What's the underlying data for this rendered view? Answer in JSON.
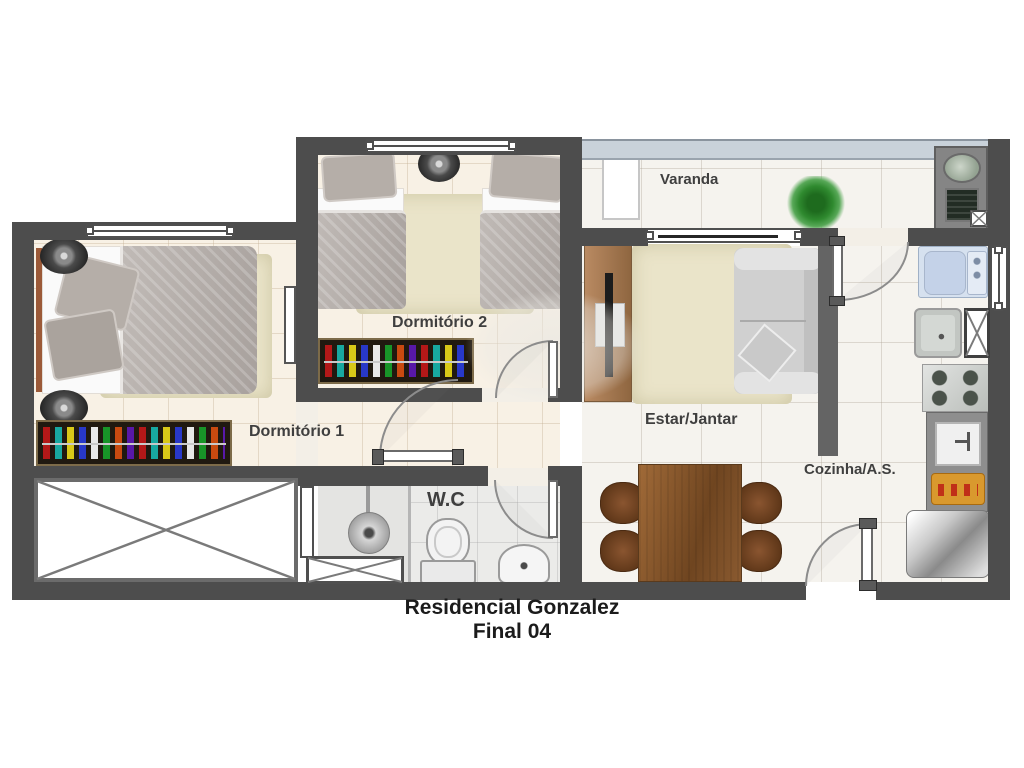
{
  "title": {
    "line1": "Residencial Gonzalez",
    "line2": "Final 04"
  },
  "rooms": {
    "varanda": "Varanda",
    "dormitorio2": "Dormitório 2",
    "dormitorio1": "Dormitório 1",
    "estar_jantar": "Estar/Jantar",
    "wc": "W.C",
    "cozinha_as": "Cozinha/A.S."
  },
  "colors": {
    "wall": "#4d4d4d",
    "floor_bedroom": "#f8f1e5",
    "floor_living": "#f5f3ee",
    "rug": "#eae4c9",
    "wood_furniture": "#8a5a30",
    "sofa_gray": "#d0d0d0",
    "plant_green": "#2f8a2f",
    "washer_blue": "#d3dfee",
    "balcony_railing": "#c9d2da"
  }
}
